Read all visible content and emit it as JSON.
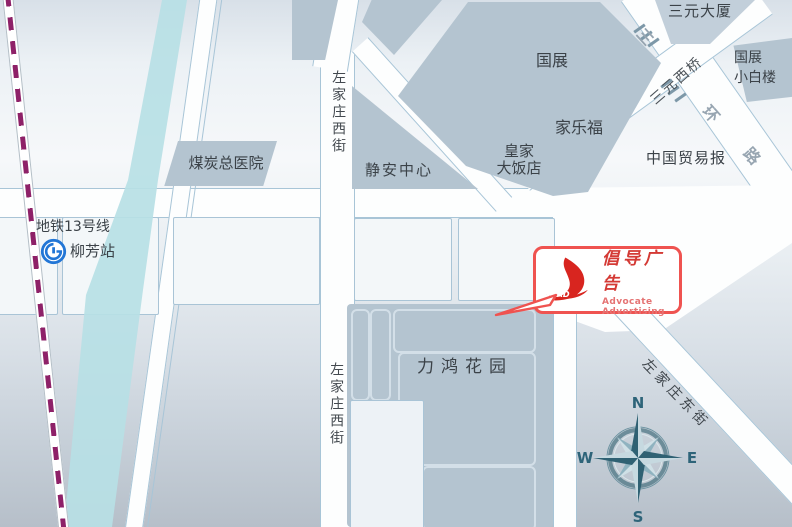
{
  "colors": {
    "accent_red": "#ef5350",
    "logo_red": "#d8251f",
    "block_gray_blue": "#b4c4d0",
    "river_cyan": "#b7e0e5",
    "metro_line_purple": "#8e2168",
    "metro_logo_blue": "#2276d6",
    "compass_teal": "#2e6479"
  },
  "metro": {
    "line_label": "地铁13号线",
    "station_label": "柳芳站"
  },
  "places": {
    "hospital": "煤炭总医院",
    "jingan_center": "静安中心",
    "guozhan": "国展",
    "carrefour": "家乐福",
    "royal_hotel_l1": "皇家",
    "royal_hotel_l2": "大饭店",
    "sanyuan_tower": "三元大厦",
    "xiaobailou_l1": "国展",
    "xiaobailou_l2": "小白楼",
    "trade_news": "中国贸易报",
    "lihong_garden": "力鸿花园"
  },
  "streets": {
    "zuojiazhuang_west": "左家庄西街",
    "zuojiazhuang_east": "左家庄东街",
    "sanyuan_west_bridge": "三元西桥",
    "third_ring": [
      "三",
      "环",
      "路"
    ]
  },
  "compass": {
    "n": "N",
    "s": "S",
    "w": "W",
    "e": "E"
  },
  "callout": {
    "logo_text": "ADAD",
    "company_cn": "倡导广告",
    "company_en": "Advocate Advertising"
  }
}
